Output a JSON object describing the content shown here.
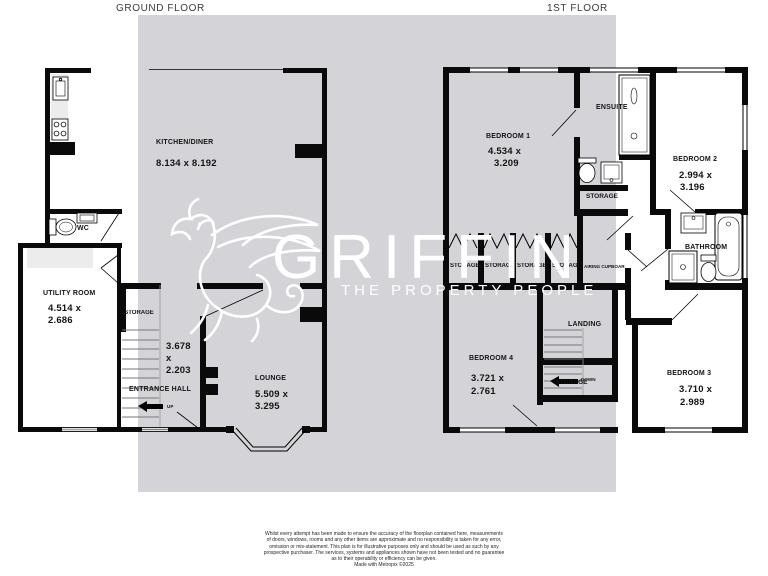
{
  "titles": {
    "ground": "GROUND FLOOR",
    "first": "1ST FLOOR"
  },
  "watermark": {
    "brand": "GRIFFIN",
    "tagline": "THE PROPERTY PEOPLE"
  },
  "gf": {
    "kitchen": {
      "name": "KITCHEN/DINER",
      "dims": "8.134 x 8.192"
    },
    "wc": {
      "name": "WC"
    },
    "utility": {
      "name": "UTILITY ROOM",
      "d1": "4.514 x",
      "d2": "2.686"
    },
    "storage": {
      "name": "STORAGE"
    },
    "stairs": {
      "d1": "3.678",
      "d2": "x",
      "d3": "2.203"
    },
    "hall": {
      "name": "ENTRANCE HALL",
      "up": "UP"
    },
    "lounge": {
      "name": "LOUNGE",
      "d1": "5.509 x",
      "d2": "3.295"
    }
  },
  "ff": {
    "bedroom1": {
      "name": "BEDROOM 1",
      "d1": "4.534 x",
      "d2": "3.209"
    },
    "ensuite": {
      "name": "ENSUITE"
    },
    "storage_small": {
      "name": "STORAGE"
    },
    "bedroom2": {
      "name": "BEDROOM 2",
      "d1": "2.994 x",
      "d2": "3.196"
    },
    "bathroom": {
      "name": "BATHROOM"
    },
    "wardrobes": [
      "STORAGE",
      "STORAGE",
      "STORAGE",
      "STORAGE"
    ],
    "airing": {
      "name": "AIRING CUPBOARD"
    },
    "landing": {
      "name": "LANDING",
      "down": "DOWN"
    },
    "storage_under": {
      "name": "STORAGE"
    },
    "bedroom4": {
      "name": "BEDROOM 4",
      "d1": "3.721 x",
      "d2": "2.761"
    },
    "bedroom3": {
      "name": "BEDROOM 3",
      "d1": "3.710 x",
      "d2": "2.989"
    }
  },
  "footer": {
    "lines": [
      "Whilst every attempt has been made to ensure the accuracy of the floorplan contained here, measurements",
      "of doors, windows, rooms and any other items are approximate and no responsibility is taken for any error,",
      "omission or mis-statement. This plan is for illustrative purposes only and should be used as such by any",
      "prospective purchaser. The services, systems and appliances shown have not been tested and no guarantee",
      "as to their operability or efficiency can be given.",
      "Made with Metropix ©2025"
    ]
  },
  "colors": {
    "watermark_bg": "#d4d4d8",
    "wall": "#0a0a0a",
    "watermark_text": "#ffffff"
  }
}
